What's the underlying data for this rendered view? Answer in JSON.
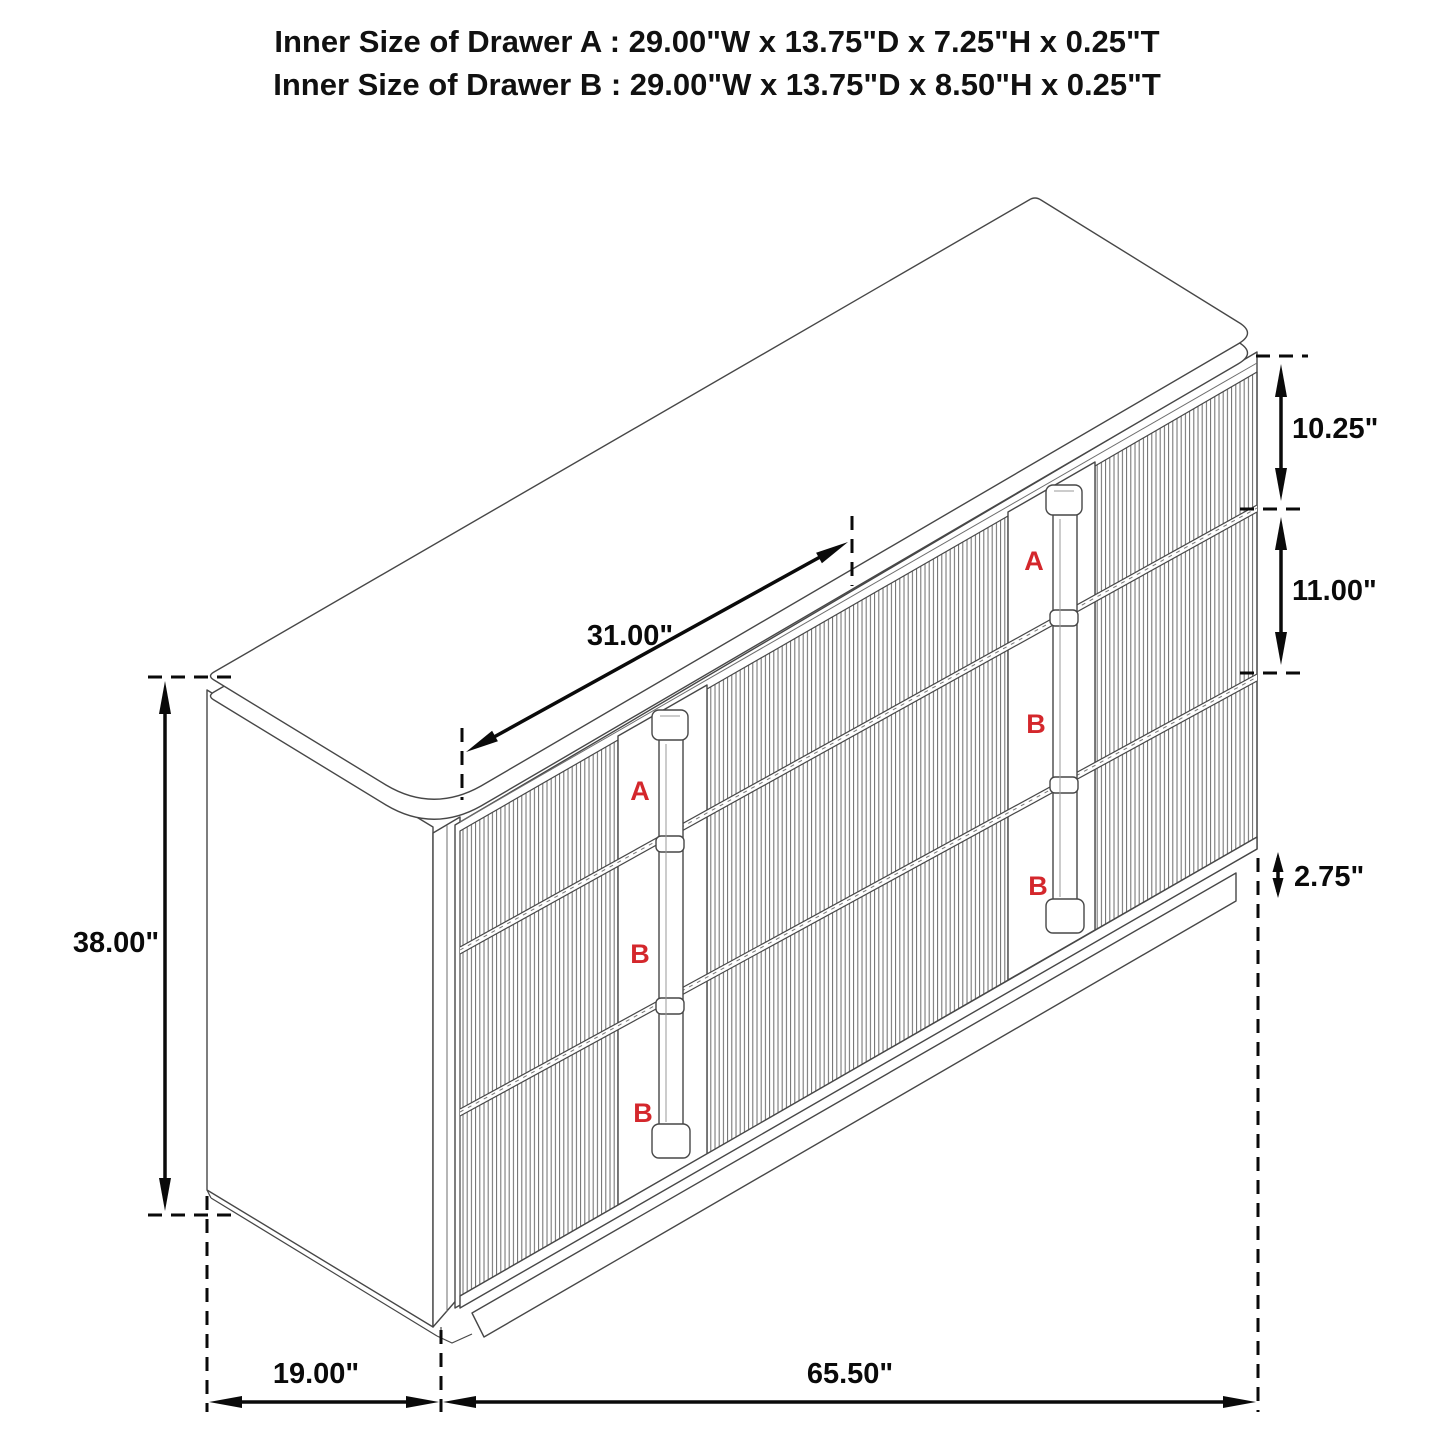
{
  "title": {
    "line1": "Inner Size of Drawer A : 29.00\"W x 13.75\"D x 7.25\"H x 0.25\"T",
    "line2": "Inner Size of Drawer B : 29.00\"W x 13.75\"D x 8.50\"H x 0.25\"T"
  },
  "diagram": {
    "object": "six-drawer dresser with fluted drawer fronts, isometric dimension drawing",
    "dimensions": {
      "top_width": "31.00\"",
      "overall_height": "38.00\"",
      "depth": "19.00\"",
      "overall_width": "65.50\"",
      "drawer_a_front_height": "10.25\"",
      "drawer_b_front_height": "11.00\"",
      "base_height": "2.75\""
    },
    "drawers": {
      "left_column": [
        "A",
        "B",
        "B"
      ],
      "right_column": [
        "A",
        "B",
        "B"
      ]
    },
    "colors": {
      "background": "#ffffff",
      "cabinet_line": "#474747",
      "dimension_line": "#0a0a0a",
      "drawer_label_red": "#d4272c"
    }
  }
}
